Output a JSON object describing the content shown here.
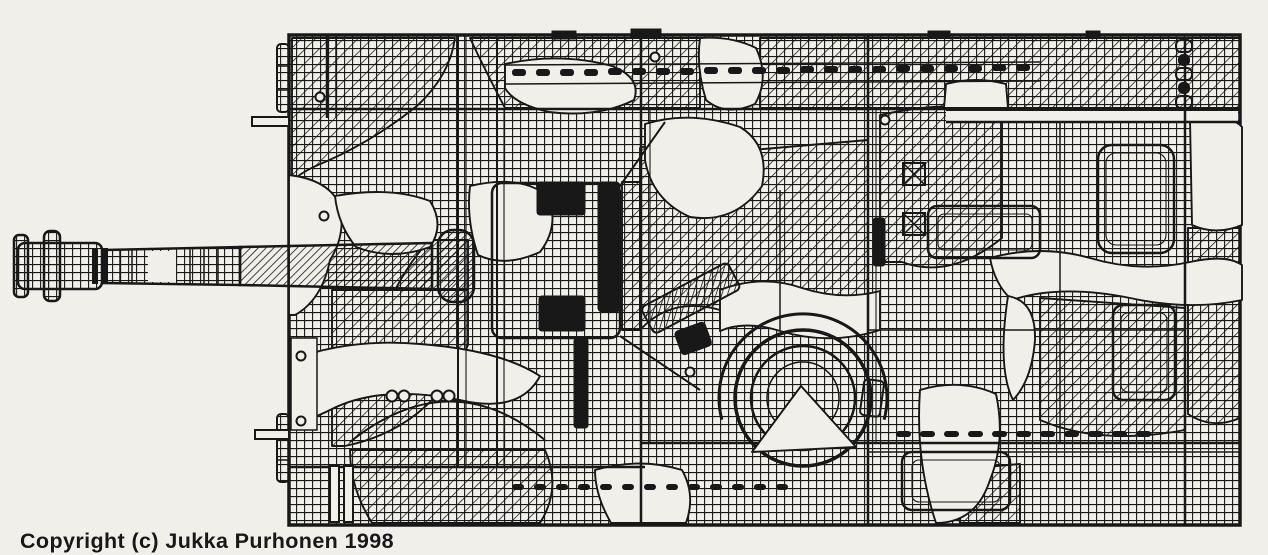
{
  "colors": {
    "paper": "#f1efea",
    "ink": "#181818"
  },
  "footer": {
    "copyright": "Copyright (c) Jukka Purhonen 1998"
  },
  "figure": {
    "type": "technical line drawing (scanned pen-and-ink plan)",
    "view": "top plan view",
    "subject": "assault-gun / tank-destroyer armoured vehicle",
    "rendering": "hard-edged splinter camouflage shown as cross-hatched, diagonally hatched, white and solid black patches",
    "elements": [
      "hull with fenders",
      "long gun barrel with double-baffle muzzle brake (pointing left)",
      "gun mount and mantlet",
      "commander's cupola ring (concentric circles)",
      "engine deck access hatches (rounded rectangles)",
      "cooling louvre slot rows",
      "tow brackets and rods on left hull edge"
    ]
  }
}
